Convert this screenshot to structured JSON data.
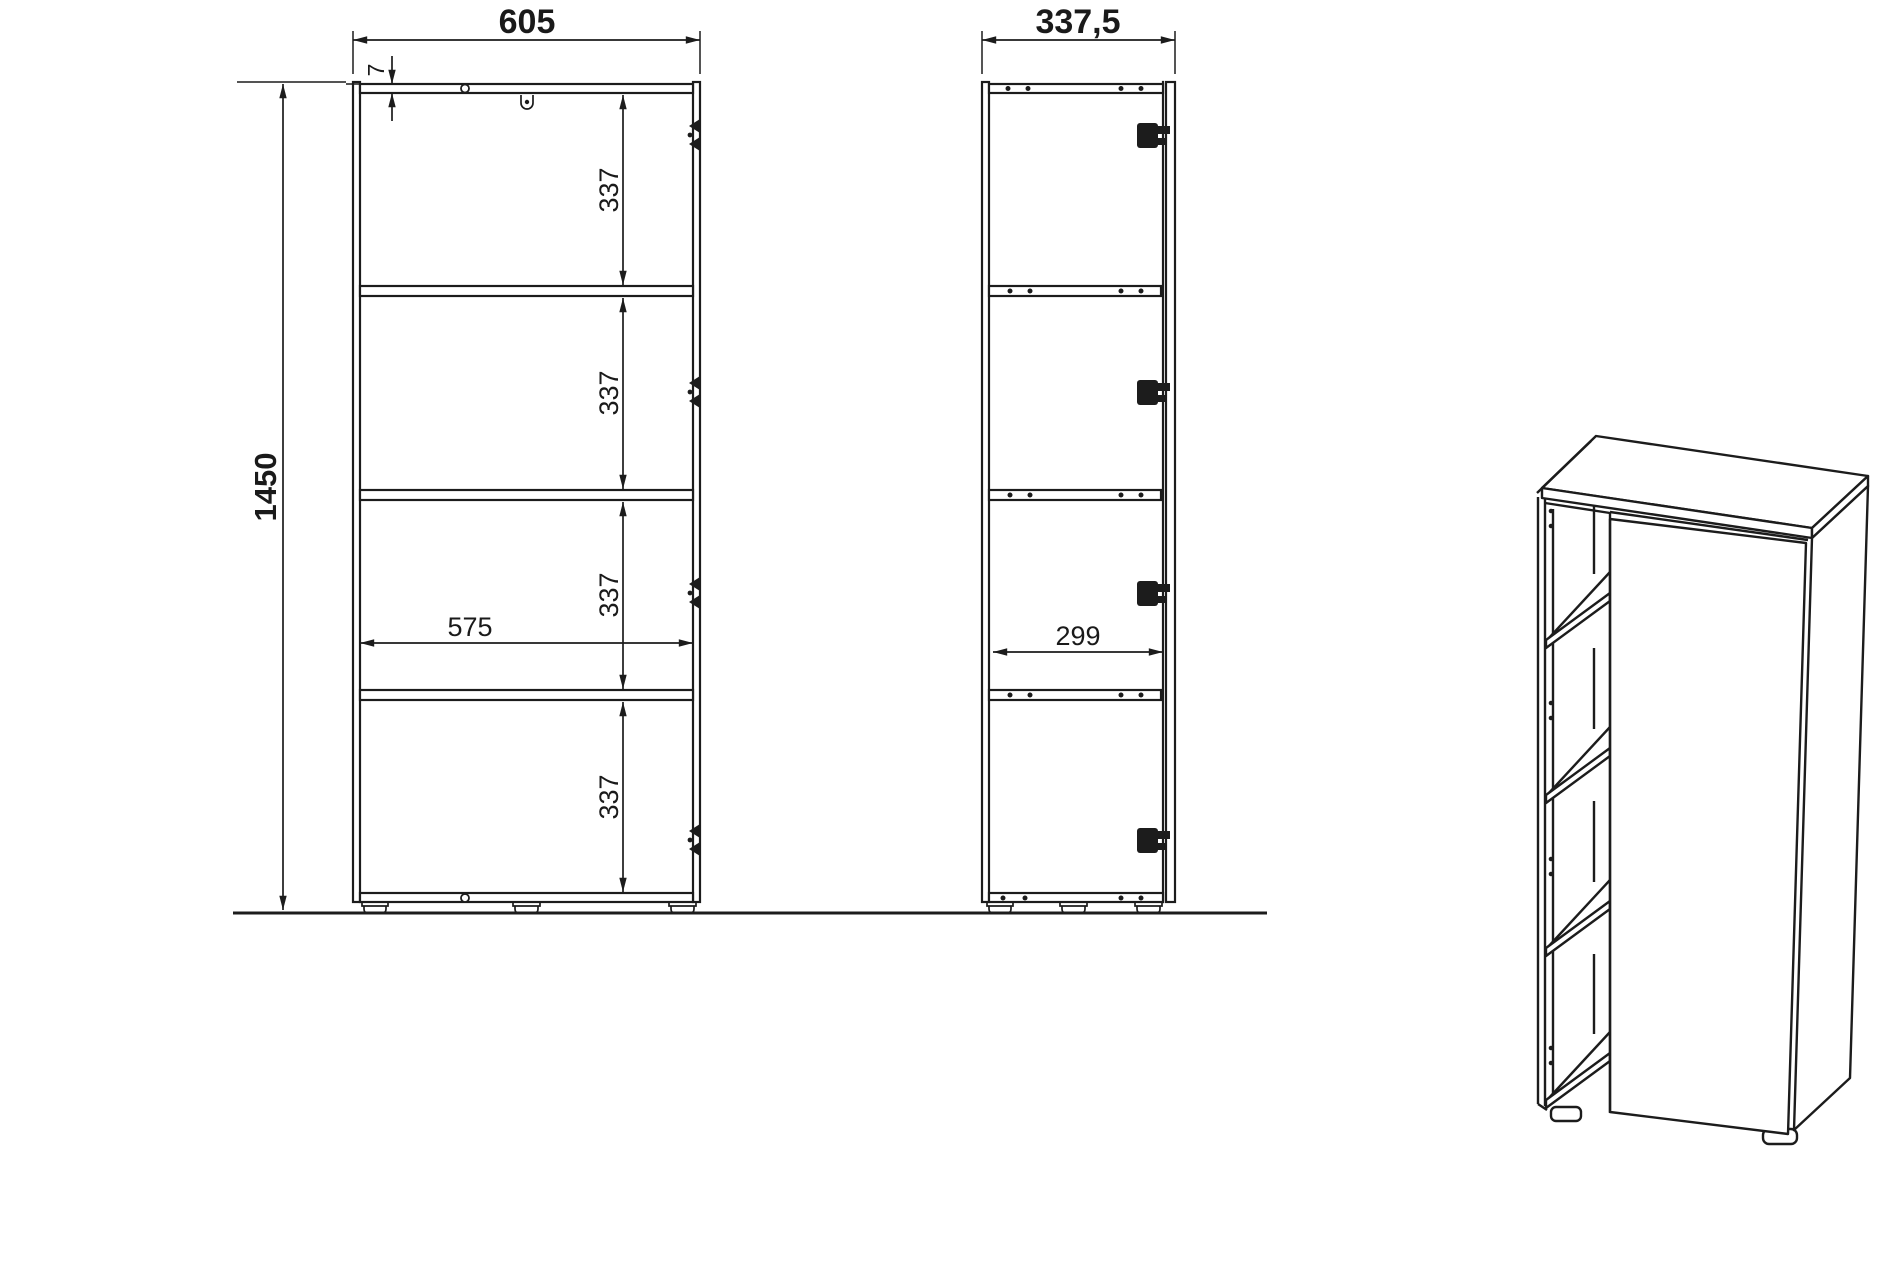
{
  "colors": {
    "background": "#ffffff",
    "line": "#1c1c1c"
  },
  "front_view": {
    "width": "605",
    "height": "1450",
    "top_panel_thickness": "7",
    "inner_width": "575",
    "shelf_spacings": [
      "337",
      "337",
      "337",
      "337"
    ]
  },
  "side_view": {
    "depth": "337,5",
    "inner_depth": "299"
  }
}
